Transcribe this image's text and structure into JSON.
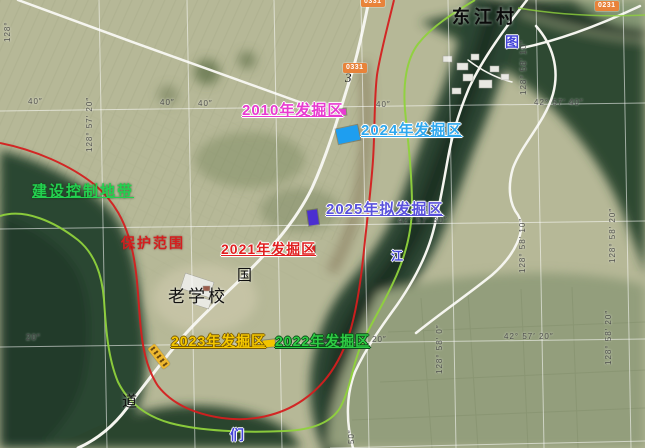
{
  "colors": {
    "excavation_2010": "#e83bd0",
    "excavation_2021": "#e02020",
    "excavation_2022": "#2ecc44",
    "excavation_2023": "#f5c800",
    "excavation_2024": "#2fa8ee",
    "excavation_2025": "#5a52dc",
    "protection_boundary": "#d41f1f",
    "control_zone_boundary": "#8fd23c",
    "road_badge_bg": "#e8833a",
    "marker_2024": "#1e9ef0",
    "marker_2025": "#4b2fd0"
  },
  "map_labels": [
    {
      "name": "village-label-dongjiangcun",
      "text": "东江村",
      "x": 452,
      "y": 8,
      "cls": "village"
    },
    {
      "name": "river-char-tu",
      "text": "图",
      "x": 505,
      "y": 35,
      "cls": "riverchar"
    },
    {
      "name": "river-char-men",
      "text": "们",
      "x": 230,
      "y": 428,
      "cls": "riverchar"
    },
    {
      "name": "river-char-jiang",
      "text": "江",
      "x": 391,
      "y": 250,
      "cls": "riverchar riverchar-sm"
    },
    {
      "name": "road-char-guo",
      "text": "国",
      "x": 237,
      "y": 269,
      "cls": "mapchar"
    },
    {
      "name": "road-char-dao",
      "text": "道",
      "x": 122,
      "y": 395,
      "cls": "mapchar"
    },
    {
      "name": "school-label",
      "text": "老学校",
      "x": 168,
      "y": 288,
      "cls": "school"
    },
    {
      "name": "road-number-3",
      "text": "3",
      "x": 345,
      "y": 71,
      "cls": "roadnum"
    },
    {
      "name": "excavation-2010-label",
      "text": "2010年发掘区",
      "x": 242,
      "y": 103,
      "cls": "exc e2010"
    },
    {
      "name": "excavation-2024-label",
      "text": "2024年发掘区",
      "x": 361,
      "y": 123,
      "cls": "exc e2024"
    },
    {
      "name": "excavation-2025-label",
      "text": "2025年拟发掘区",
      "x": 326,
      "y": 202,
      "cls": "exc e2025"
    },
    {
      "name": "excavation-2021-label",
      "text": "2021年发掘区",
      "x": 221,
      "y": 242,
      "cls": "exc e2021"
    },
    {
      "name": "excavation-2023-label",
      "text": "2023年发掘区",
      "x": 171,
      "y": 334,
      "cls": "exc e2023"
    },
    {
      "name": "excavation-2022-label",
      "text": "2022年发掘区",
      "x": 275,
      "y": 334,
      "cls": "exc e2022"
    },
    {
      "name": "protection-range-label",
      "text": "保护范围",
      "x": 121,
      "y": 236,
      "cls": "protect"
    },
    {
      "name": "construction-control-zone-label",
      "text": "建设控制地带",
      "x": 32,
      "y": 184,
      "cls": "control"
    }
  ],
  "grid_labels": [
    {
      "text": "40″",
      "x": 28,
      "y": 98,
      "rot": 0
    },
    {
      "text": "40″",
      "x": 160,
      "y": 99,
      "rot": 0
    },
    {
      "text": "40″",
      "x": 198,
      "y": 100,
      "rot": 0
    },
    {
      "text": "40″",
      "x": 376,
      "y": 101,
      "rot": 0
    },
    {
      "text": "42° 57′ 40″",
      "x": 534,
      "y": 99,
      "rot": 0
    },
    {
      "text": "42° 57′ 30″",
      "x": 398,
      "y": 217,
      "rot": 0
    },
    {
      "text": "20″",
      "x": 26,
      "y": 334,
      "rot": 0
    },
    {
      "text": "20″",
      "x": 372,
      "y": 336,
      "rot": 0
    },
    {
      "text": "42° 57′ 20″",
      "x": 504,
      "y": 333,
      "rot": 0
    },
    {
      "text": "128°",
      "x": 4,
      "y": 42,
      "rot": -90
    },
    {
      "text": "128° 57′ 20″",
      "x": 86,
      "y": 152,
      "rot": -90
    },
    {
      "text": "128° 58′ 10″",
      "x": 520,
      "y": 95,
      "rot": -90
    },
    {
      "text": "128° 58′ 10″",
      "x": 519,
      "y": 273,
      "rot": -90
    },
    {
      "text": "128° 58′ 0″",
      "x": 436,
      "y": 374,
      "rot": -90
    },
    {
      "text": "128° 58′ 20″",
      "x": 609,
      "y": 263,
      "rot": -90
    },
    {
      "text": "128° 58′ 20″",
      "x": 605,
      "y": 365,
      "rot": -90
    },
    {
      "text": "50″",
      "x": 348,
      "y": 444,
      "rot": -90
    }
  ],
  "road_badges": [
    {
      "name": "road-badge-0331-top",
      "text": "0331",
      "x": 361,
      "y": -3
    },
    {
      "name": "road-badge-0331",
      "text": "0331",
      "x": 343,
      "y": 63
    },
    {
      "name": "road-badge-0231",
      "text": "0231",
      "x": 595,
      "y": 1
    }
  ],
  "area_markers": [
    {
      "name": "marker-2024-excavation-area",
      "color": "#1e9ef0",
      "x": 337,
      "y": 127,
      "w": 22,
      "h": 15,
      "rot": -12
    },
    {
      "name": "marker-2025-planned-area",
      "color": "#4b2fd0",
      "x": 308,
      "y": 210,
      "w": 10,
      "h": 15,
      "rot": -8
    },
    {
      "name": "marker-2021-excavation-area",
      "color": "#d42020",
      "x": 306,
      "y": 246,
      "w": 9,
      "h": 7,
      "rot": 0
    },
    {
      "name": "marker-2023-excavation-area",
      "color": "#f2c400",
      "x": 263,
      "y": 340,
      "w": 12,
      "h": 7,
      "rot": -6
    },
    {
      "name": "marker-2010-excavation-area",
      "color": "#e83bd0",
      "x": 338,
      "y": 109,
      "w": 8,
      "h": 6,
      "rot": -6
    }
  ]
}
